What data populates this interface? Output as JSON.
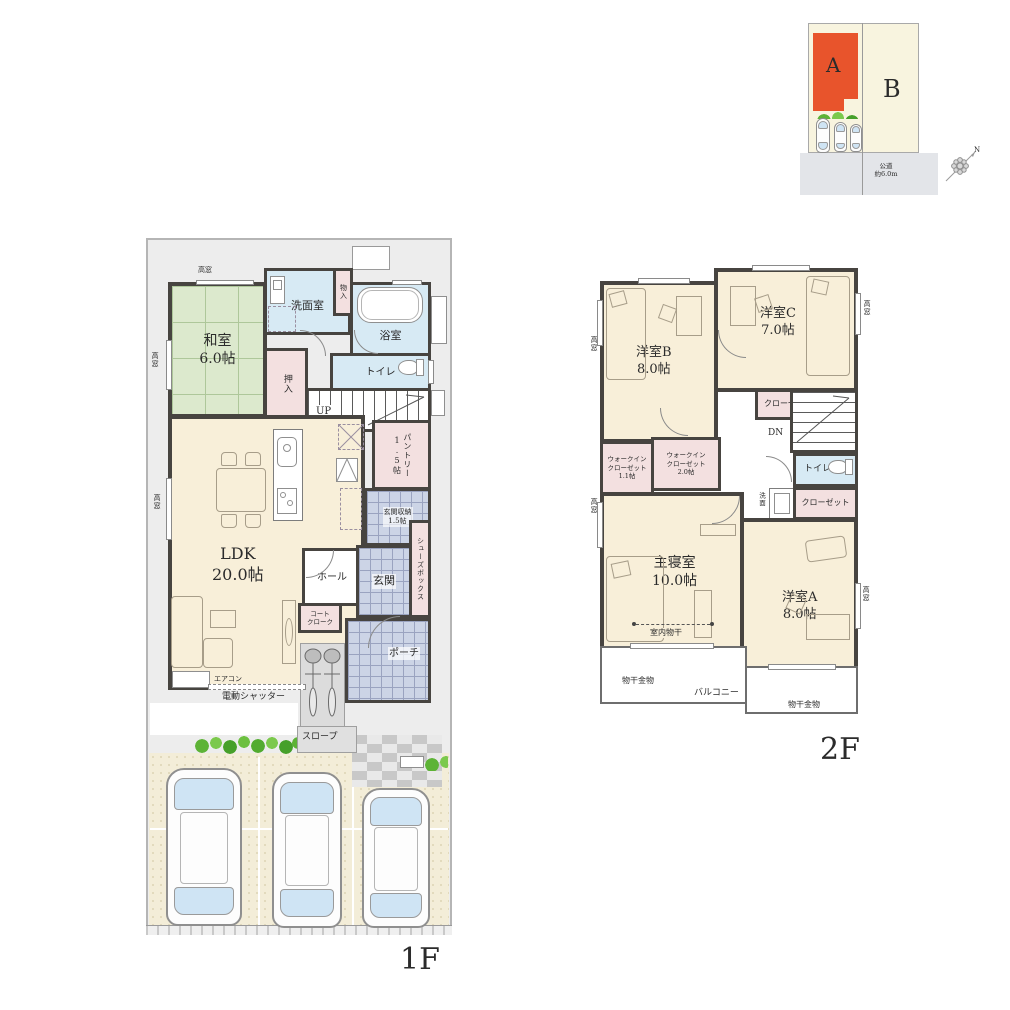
{
  "site_plan": {
    "lot_a_label": "A",
    "lot_b_label": "B",
    "road_label": "公道\n約6.0m",
    "north_label": "N"
  },
  "floor1": {
    "floor_label": "1F",
    "rooms": {
      "washitsu": "和室\n6.0帖",
      "senmenshitsu": "洗面室",
      "mono_ire": "物入",
      "yokushitsu": "浴室",
      "toilet": "トイレ",
      "oshiire": "押入",
      "stairs_up": "UP",
      "pantry": "パントリー1.5帖",
      "ldk": "LDK\n20.0帖",
      "genkan_shuno": "玄関収納\n1.5帖",
      "hall": "ホール",
      "genkan": "玄関",
      "shoes_box": "シューズボックス",
      "coat_cloak": "コート\nクローク",
      "porch": "ポーチ"
    },
    "annotations": {
      "takamado": "高窓",
      "aircon": "エアコン",
      "electric_shutter": "電動シャッター",
      "slope": "スロープ"
    }
  },
  "floor2": {
    "floor_label": "2F",
    "rooms": {
      "yoshitsu_b": "洋室B\n8.0帖",
      "yoshitsu_c": "洋室C\n7.0帖",
      "closet": "クローゼット",
      "stairs_down": "DN",
      "wic_1_1": "ウォークイン\nクローゼット\n1.1帖",
      "wic_2_0": "ウォークイン\nクローゼット\n2.0帖",
      "toilet": "トイレ",
      "senmen": "洗面",
      "shushinshitsu": "主寝室\n10.0帖",
      "yoshitsu_a": "洋室A\n8.0帖",
      "balcony": "バルコニー"
    },
    "annotations": {
      "takamado": "高窓",
      "indoor_drying": "室内物干",
      "drying_hardware": "物干金物"
    }
  },
  "colors": {
    "wall": "#474440",
    "tatami_green": "#dce9cd",
    "water_blue": "#d7eaf4",
    "closet_pink": "#f3e0e0",
    "floor_cream": "#f8efd9",
    "tile_blue": "#ccd4e6",
    "site_building_orange": "#e8542c",
    "site_lot_cream": "#f8f4df",
    "road_gray": "#e3e5e9"
  }
}
